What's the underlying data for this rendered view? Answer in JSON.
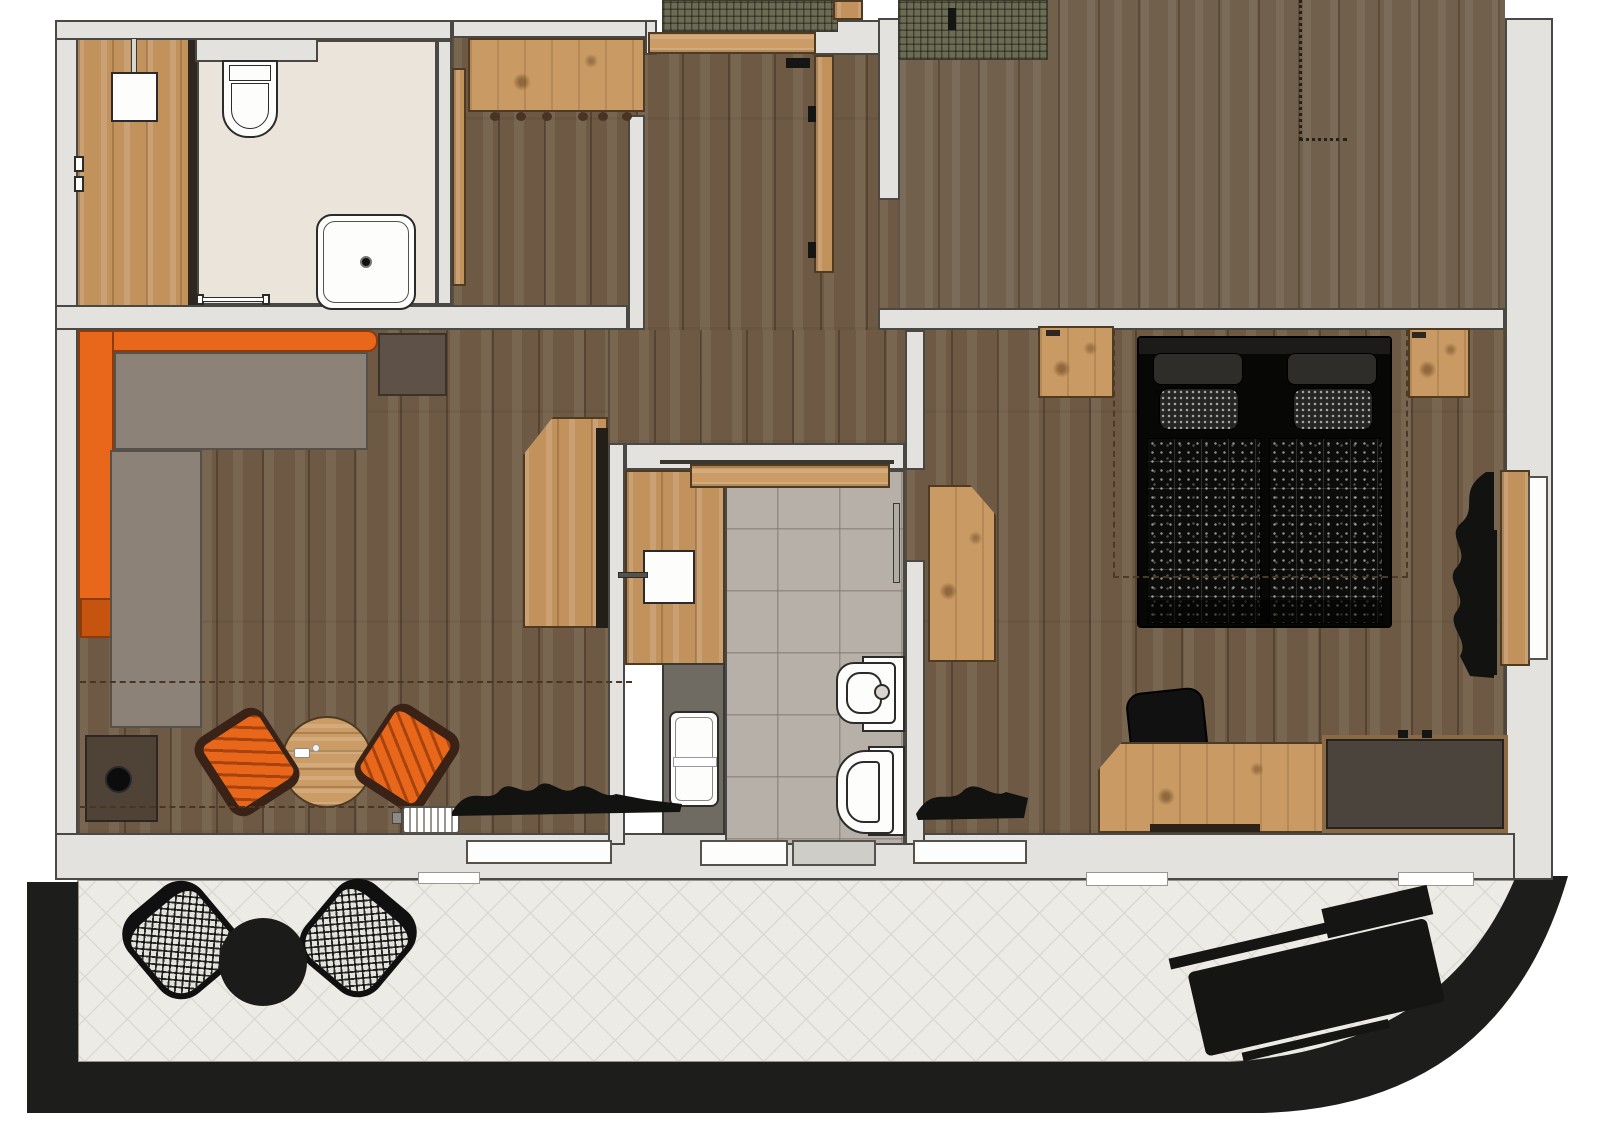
{
  "page": {
    "title": "Apartment floor plan (top view)"
  },
  "colors": {
    "wall_fill": "#e3e2de",
    "wall_line": "#4a4844",
    "floor_dark_wood": "#6e5a44",
    "floor_light_wood": "#c2925d",
    "bath_tile": "#b7b0a8",
    "beige_tile": "#eae4da",
    "terrace_tile": "#edebe6",
    "terrace_band": "#1d1d1b",
    "sofa_orange": "#e8671a",
    "sofa_seat_gray": "#8d8277",
    "accent_black": "#151513",
    "mat_olive": "#6c6c55"
  },
  "labels": {
    "plan": "Apartment floor plan",
    "utility_room": "Shower / utility room",
    "hallway": "Entrance hall",
    "top_right_room": "Adjoining room",
    "living_room": "Living room",
    "bathroom": "Bathroom",
    "bedroom": "Bedroom",
    "terrace": "Terrace",
    "entry_mat": "Entry doormat",
    "entry_door": "Entrance door",
    "wardrobe": "Hall wardrobe with coat hooks",
    "sliding_door_utility": "Sliding door",
    "washbasin": "Washbasin",
    "shower_tray": "Shower tray",
    "sink_unit": "Sink unit",
    "sofa": "Corner sofa",
    "side_table": "Side table",
    "kitchenette": "Kitchenette counter",
    "cabinet": "Low cabinet with plant",
    "dining_table": "Round dining table",
    "tub_chair": "Tub chair",
    "radiator": "Radiator",
    "vanity": "Bathroom vanity with sink",
    "shower": "Shower enclosure",
    "bidet": "Bidet",
    "toilet": "Toilet",
    "towel_rail": "Towel rail",
    "bath_sliding_door": "Bathroom sliding door",
    "corner_wardrobe": "Corner wardrobe",
    "nightstand": "Nightstand",
    "double_bed": "Double bed",
    "desk": "Desk",
    "desk_chair": "Desk chair",
    "sideboard": "Sideboard",
    "window": "Window",
    "terrace_door": "Terrace door",
    "curtain": "Curtain",
    "patio_chair": "Patio chair",
    "patio_table": "Patio table",
    "sun_lounger": "Sun lounger"
  }
}
